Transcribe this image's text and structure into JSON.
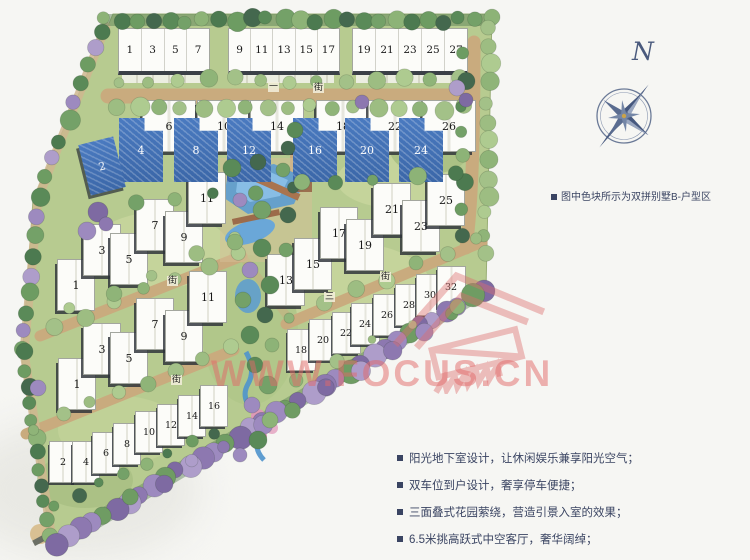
{
  "legend": {
    "note": "图中色块所示为双拼别墅B-户型区"
  },
  "features": [
    "阳光地下室设计，让休闲娱乐兼享阳光空气；",
    "双车位到户设计，奢享停车便捷；",
    "三面叠式花园萦绕，营造引景入室的效果；",
    "6.5米挑高跃式中空客厅，奢华阔绰；"
  ],
  "compass": {
    "label": "N"
  },
  "watermark": {
    "text": "WWW.FOCUS.CN"
  },
  "streets": {
    "top_prefix": "一",
    "top": "街",
    "left_upper": "街",
    "left_lower": "街",
    "right": "街",
    "right_num": "三"
  },
  "site": {
    "top_row_blocks": [
      [
        "1",
        "3",
        "5",
        "7"
      ],
      [
        "9",
        "11",
        "13",
        "15",
        "17"
      ],
      [
        "19",
        "21",
        "23",
        "25",
        "27"
      ]
    ],
    "duplex_pairs": [
      {
        "blue": "4",
        "white": "6"
      },
      {
        "blue": "8",
        "white": "10"
      },
      {
        "blue": "12",
        "white": "14"
      },
      {
        "blue": "16",
        "white": "18"
      },
      {
        "blue": "20",
        "white": "22"
      },
      {
        "blue": "24",
        "white": "26"
      }
    ],
    "lone_blue": "2",
    "rows": {
      "left_upper": [
        "1",
        "3",
        "5",
        "7",
        "9",
        "11"
      ],
      "left_lower": [
        "1",
        "3",
        "5",
        "7",
        "9",
        "11"
      ],
      "left_bottom": [
        "2",
        "4",
        "6",
        "8",
        "10",
        "12",
        "14",
        "16"
      ],
      "right_upper": [
        "13",
        "15",
        "17",
        "19",
        "21",
        "23",
        "25"
      ],
      "right_lower": [
        "18",
        "20",
        "22",
        "24",
        "26",
        "28",
        "30",
        "32"
      ]
    }
  },
  "colors": {
    "highlight_blue": "#4476bb",
    "watermark_red": "#e05a5a",
    "annotation_navy": "#3a4462",
    "site_green": "#b7cb90",
    "path_tan": "#c9ab7e",
    "water_blue": "#5b9bd1",
    "purple_tree": "#9b87bd"
  }
}
